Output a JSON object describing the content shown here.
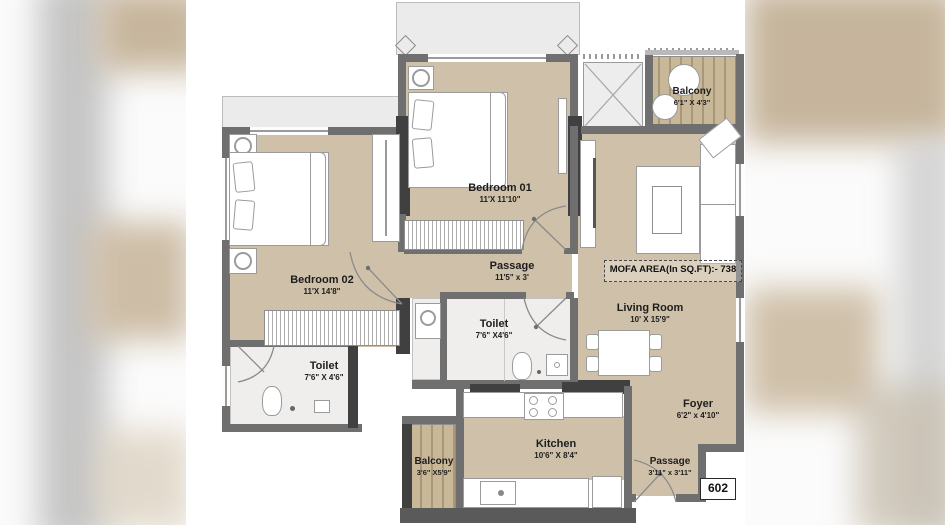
{
  "plan": {
    "unit_number": "602",
    "mofa_area": "MOFA AREA(In SQ.FT):- 738",
    "rooms": {
      "bedroom01": {
        "name": "Bedroom 01",
        "dims": "11'X 11'10\""
      },
      "bedroom02": {
        "name": "Bedroom 02",
        "dims": "11'X 14'8\""
      },
      "passage_mid": {
        "name": "Passage",
        "dims": "11'5\" x 3'"
      },
      "toilet_mid": {
        "name": "Toilet",
        "dims": "7'6\" X4'6\""
      },
      "toilet_left": {
        "name": "Toilet",
        "dims": "7'6\" X 4'6\""
      },
      "living_room": {
        "name": "Living Room",
        "dims": "10' X 15'9\""
      },
      "balcony_top": {
        "name": "Balcony",
        "dims": "6'1\" X 4'3\""
      },
      "foyer": {
        "name": "Foyer",
        "dims": "6'2\" x 4'10\""
      },
      "kitchen": {
        "name": "Kitchen",
        "dims": "10'6\" X 8'4\""
      },
      "balcony_bottom": {
        "name": "Balcony",
        "dims": "3'6\" X5'9\""
      },
      "passage_entry": {
        "name": "Passage",
        "dims": "3'11\" x 3'11\""
      }
    },
    "colors": {
      "floor_beige": "#cfc1a9",
      "balcony_wood": "#b9a888",
      "wall_gray": "#6f6f6f",
      "wall_dark": "#404040",
      "tile_white": "#efeeec",
      "label_text": "#1d1d1d"
    }
  }
}
